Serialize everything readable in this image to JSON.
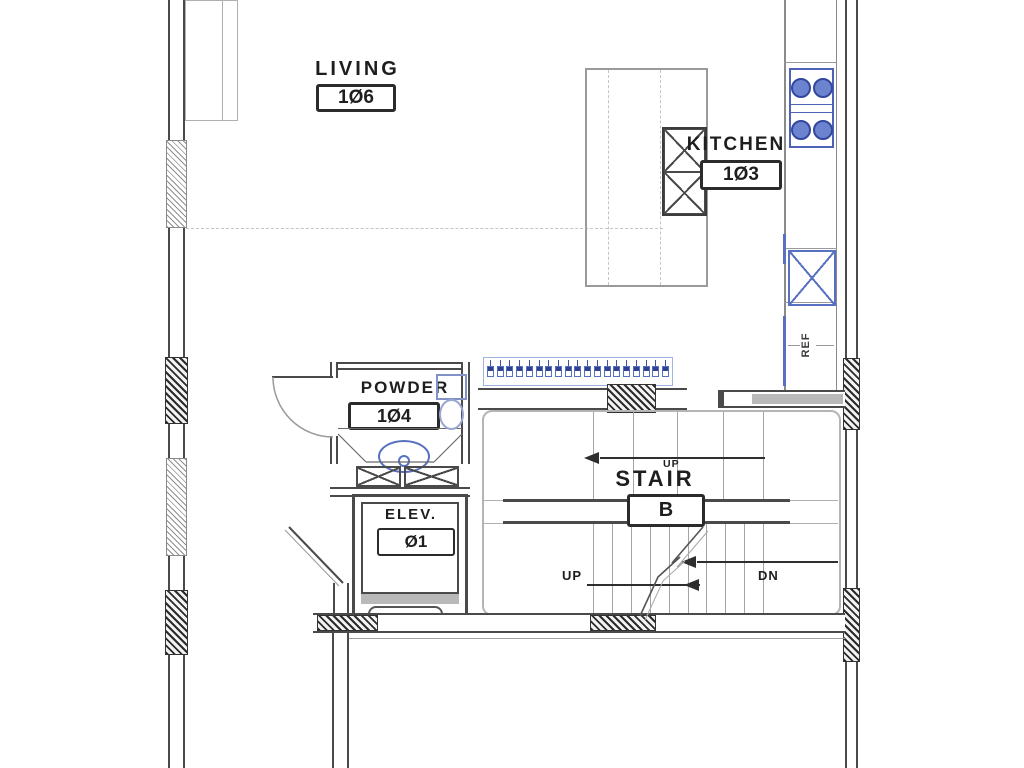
{
  "drawing": {
    "type": "architectural floor plan",
    "rooms": {
      "living": {
        "name": "LIVING",
        "number": "1Ø6"
      },
      "kitchen": {
        "name": "KITCHEN",
        "number": "1Ø3"
      },
      "powder": {
        "name": "POWDER",
        "number": "1Ø4"
      },
      "elevator": {
        "name": "ELEV.",
        "number": "Ø1"
      },
      "stair": {
        "name": "STAIR",
        "number": "B"
      }
    },
    "annotations": {
      "up_small": "UP",
      "up": "UP",
      "dn": "DN",
      "ref": "REF"
    },
    "colors": {
      "line_dark": "#4a4a4a",
      "line_light": "#b5b5b5",
      "fixture_blue": "#5870c2",
      "fill_gray": "#b9b9b9"
    },
    "fixtures": {
      "closet_hanger_count": 19,
      "cooktop_burner_count": 4,
      "stair_upper_tread_count": 5,
      "stair_lower_tread_count": 10
    }
  }
}
